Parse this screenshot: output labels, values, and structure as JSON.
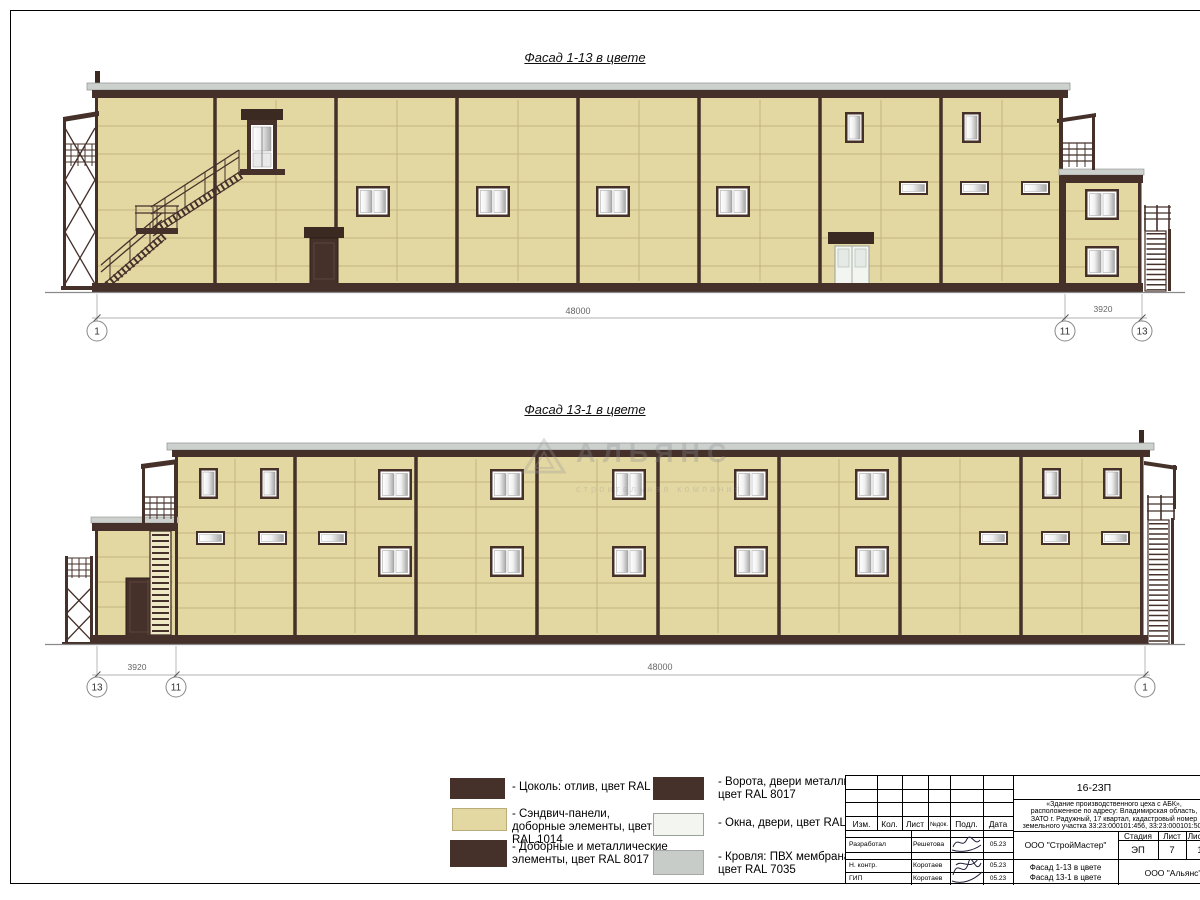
{
  "colors": {
    "panel_ral1014": "#E3D7A2",
    "brown_ral8017": "#45302A",
    "windows_ral9003": "#F2F5F0",
    "roof_ral7035": "#CDD1CE"
  },
  "facade1": {
    "title": "Фасад 1-13 в цвете",
    "dim_main": "48000",
    "dim_annex": "3920",
    "axes": {
      "left": "1",
      "mid": "11",
      "right": "13"
    }
  },
  "facade2": {
    "title": "Фасад 13-1 в цвете",
    "dim_annex": "3920",
    "dim_main": "48000",
    "axes": {
      "left": "13",
      "mid": "11",
      "right": "1"
    }
  },
  "watermark": {
    "name": "АЛЬЯНС",
    "subtitle": "строительная компания"
  },
  "legend": {
    "items": [
      {
        "color": "#45302A",
        "label": "- Цоколь: отлив, цвет RAL 8017"
      },
      {
        "color": "#E3D7A2",
        "label": "- Сэндвич-панели, доборные элементы, цвет RAL 1014"
      },
      {
        "color": "#45302A",
        "label": "- Доборные и металлические элементы, цвет RAL 8017"
      },
      {
        "color": "#45302A",
        "label": "- Ворота, двери металлические, цвет RAL 8017"
      },
      {
        "color": "#F2F5F0",
        "label": "- Окна, двери, цвет RAL 9003"
      },
      {
        "color": "#C8CCC9",
        "label": "- Кровля: ПВХ мембрана, цвет RAL 7035"
      }
    ]
  },
  "titleblock": {
    "doc_number": "16-23П",
    "project": {
      "line1": "«Здание производственного цеха с АБК»,",
      "line2": "расположенное по адресу: Владимирская область,",
      "line3": "ЗАТО г. Радужный, 17 квартал, кадастровый номер",
      "line4": "земельного участка 33:23:000101:456, 33:23:000101:508"
    },
    "columns": {
      "izm": "Изм.",
      "kol": "Кол.",
      "list": "Лист",
      "ndok": "№док.",
      "podp": "Подл.",
      "data": "Дата"
    },
    "rows": [
      {
        "role": "Разработал",
        "name": "Решетова",
        "date": "05.23"
      },
      {
        "role": "Н. контр.",
        "name": "Коротаев",
        "date": "05.23"
      },
      {
        "role": "ГИП",
        "name": "Коротаев",
        "date": "05.23"
      }
    ],
    "org_designer": "ООО \"СтройМастер\"",
    "stage": {
      "label": "Стадия",
      "value": "ЭП"
    },
    "sheet": {
      "label": "Лист",
      "value": "7"
    },
    "sheets": {
      "label": "Листов",
      "value": "1"
    },
    "drawing_titles": {
      "line1": "Фасад 1-13 в цвете",
      "line2": "Фасад 13-1 в цвете"
    },
    "org_client": "ООО \"Альянс\""
  }
}
